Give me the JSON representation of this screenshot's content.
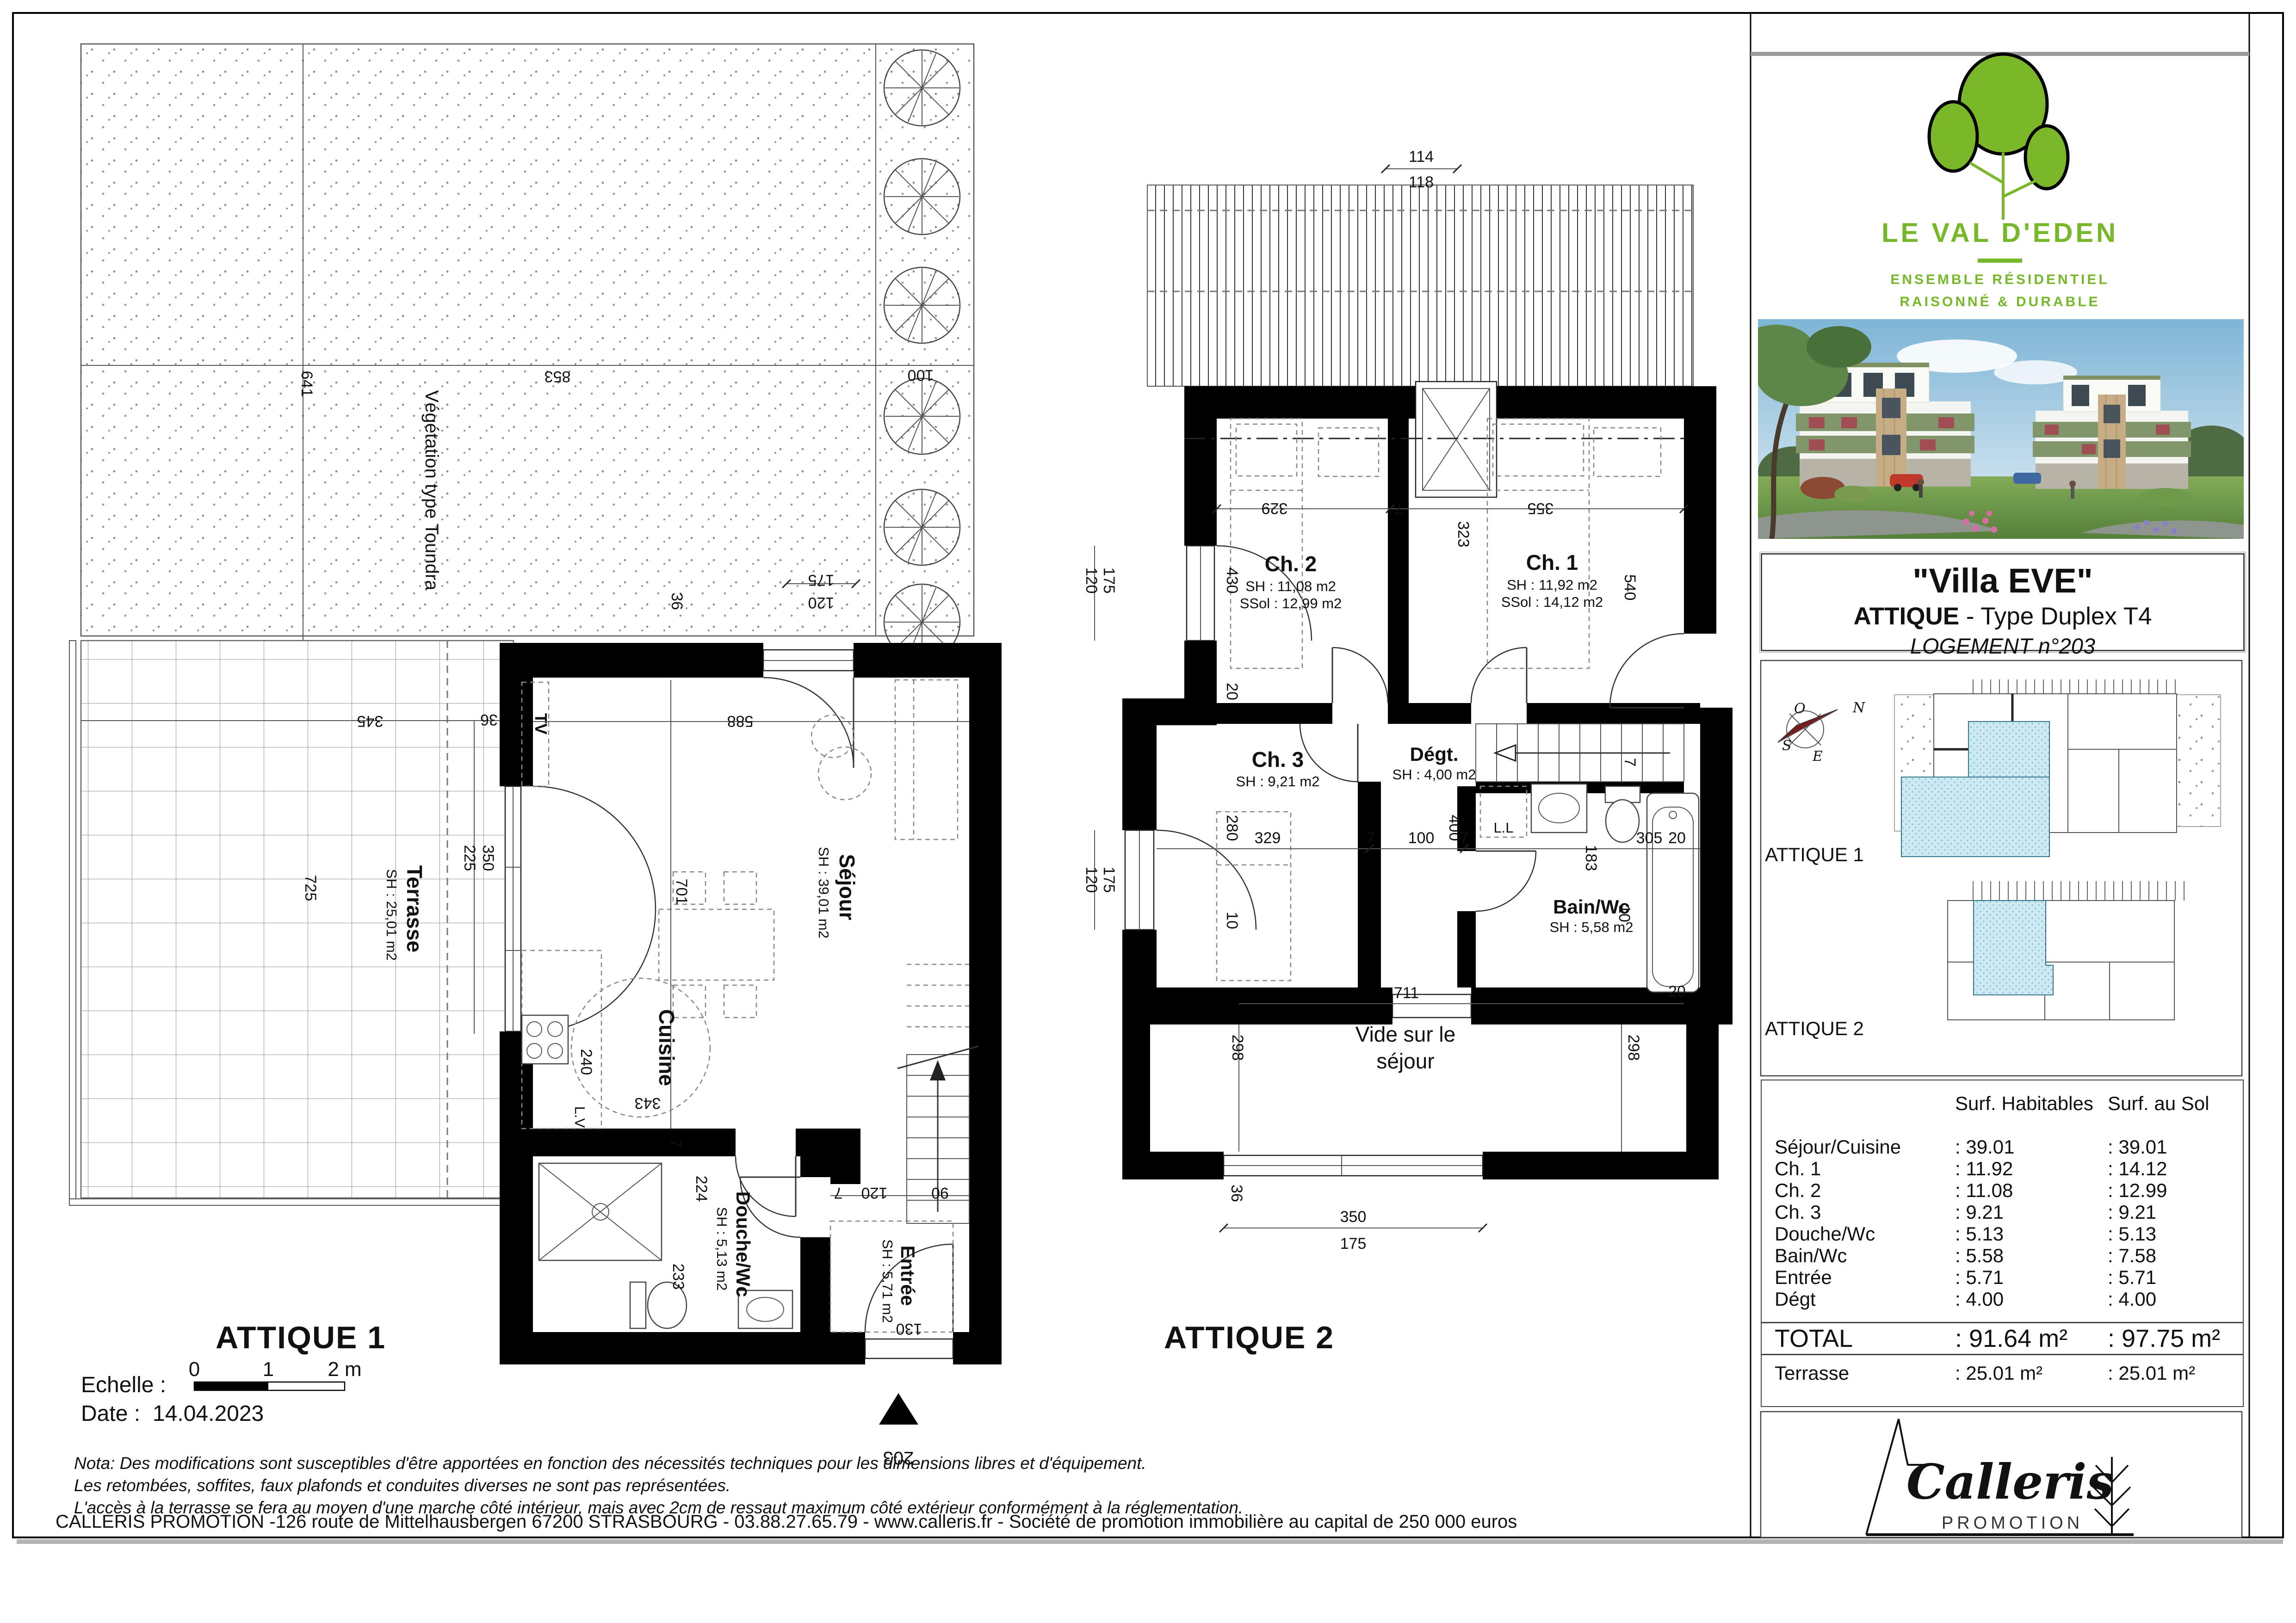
{
  "sheet": {
    "scale_label": "Echelle :",
    "scale_ticks": [
      "0",
      "1",
      "2 m"
    ],
    "date_label": "Date :",
    "date_value": "14.04.2023",
    "nota_lines": [
      "Nota: Des modifications sont susceptibles d'être apportées en fonction des nécessités techniques pour les dimensions libres et d'équipement.",
      "Les retombées, soffites, faux plafonds et conduites diverses ne sont pas représentées.",
      "L'accès à la terrasse se fera au moyen d'une marche côté intérieur, mais avec 2cm de ressaut maximum côté extérieur conformément à la réglementation."
    ],
    "address": "CALLERIS PROMOTION -126 route de Mittelhausbergen 67200 STRASBOURG - 03.88.27.65.79 - www.calleris.fr - Société de promotion immobilière au capital de 250 000 euros"
  },
  "plan1": {
    "title": "ATTIQUE 1",
    "rooms": {
      "vegetation": "Végétation type Toundra",
      "terrasse": {
        "name": "Terrasse",
        "area": "SH : 25,01 m2"
      },
      "sejour": {
        "name": "Séjour",
        "area": "SH : 39,01 m2"
      },
      "cuisine": "Cuisine",
      "tv": "TV",
      "lv": "L.V",
      "douche": {
        "name": "Douche/Wc",
        "area": "SH : 5,13 m2"
      },
      "entree": {
        "name": "Entrée",
        "area": "SH : 5,71 m2"
      },
      "unit_number": "203"
    },
    "dims": [
      "641",
      "853",
      "100",
      "175",
      "120",
      "36",
      "345",
      "350",
      "225",
      "36",
      "725",
      "588",
      "701",
      "240",
      "343",
      "7",
      "120",
      "90",
      "224",
      "233",
      "130",
      "7"
    ]
  },
  "plan2": {
    "title": "ATTIQUE 2",
    "rooms": {
      "ch2": {
        "name": "Ch. 2",
        "sh": "SH : 11,08 m2",
        "ssol": "SSol : 12,99 m2"
      },
      "ch1": {
        "name": "Ch. 1",
        "sh": "SH : 11,92 m2",
        "ssol": "SSol : 14,12 m2"
      },
      "ch3": {
        "name": "Ch. 3",
        "sh": "SH : 9,21 m2"
      },
      "degt": {
        "name": "Dégt.",
        "sh": "SH : 4,00 m2"
      },
      "bain": {
        "name": "Bain/Wc",
        "sh": "SH : 5,58 m2"
      },
      "ll": "L.L",
      "vide1": "Vide sur le",
      "vide2": "séjour"
    },
    "dims": [
      "114",
      "118",
      "329",
      "7",
      "323",
      "355",
      "430",
      "540",
      "20",
      "120",
      "175",
      "120",
      "175",
      "280",
      "329",
      "7",
      "100",
      "7",
      "305",
      "183",
      "20",
      "400",
      "10",
      "10",
      "7",
      "711",
      "20",
      "298",
      "298",
      "36",
      "350",
      "175"
    ]
  },
  "sidebar": {
    "logo": {
      "title": "LE VAL D'EDEN",
      "sub1": "ENSEMBLE RÉSIDENTIEL",
      "sub2": "RAISONNÉ & DURABLE"
    },
    "titleblock": {
      "line1": "\"Villa EVE\"",
      "line2_bold": "ATTIQUE",
      "line2_rest": " - Type Duplex T4",
      "line3": "LOGEMENT n°203"
    },
    "compass": {
      "n": "N",
      "o": "O",
      "s": "S",
      "e": "E"
    },
    "keyplans": {
      "label1": "ATTIQUE 1",
      "label2": "ATTIQUE 2"
    },
    "table": {
      "col1": "Surf. Habitables",
      "col2": "Surf. au Sol",
      "rows": [
        {
          "label": "Séjour/Cuisine",
          "hab": ": 39.01",
          "sol": ": 39.01"
        },
        {
          "label": "Ch. 1",
          "hab": ": 11.92",
          "sol": ": 14.12"
        },
        {
          "label": "Ch. 2",
          "hab": ": 11.08",
          "sol": ": 12.99"
        },
        {
          "label": "Ch. 3",
          "hab": ": 9.21",
          "sol": ": 9.21"
        },
        {
          "label": "Douche/Wc",
          "hab": ": 5.13",
          "sol": ": 5.13"
        },
        {
          "label": "Bain/Wc",
          "hab": ": 5.58",
          "sol": ": 7.58"
        },
        {
          "label": "Entrée",
          "hab": ": 5.71",
          "sol": ": 5.71"
        },
        {
          "label": "Dégt",
          "hab": ": 4.00",
          "sol": ": 4.00"
        }
      ],
      "total": {
        "label": "TOTAL",
        "hab": ": 91.64 m²",
        "sol": ": 97.75 m²"
      },
      "terrasse": {
        "label": "Terrasse",
        "hab": ": 25.01 m²",
        "sol": ": 25.01 m²"
      }
    },
    "promoter": {
      "name": "Calleris",
      "sub": "PROMOTION"
    }
  }
}
